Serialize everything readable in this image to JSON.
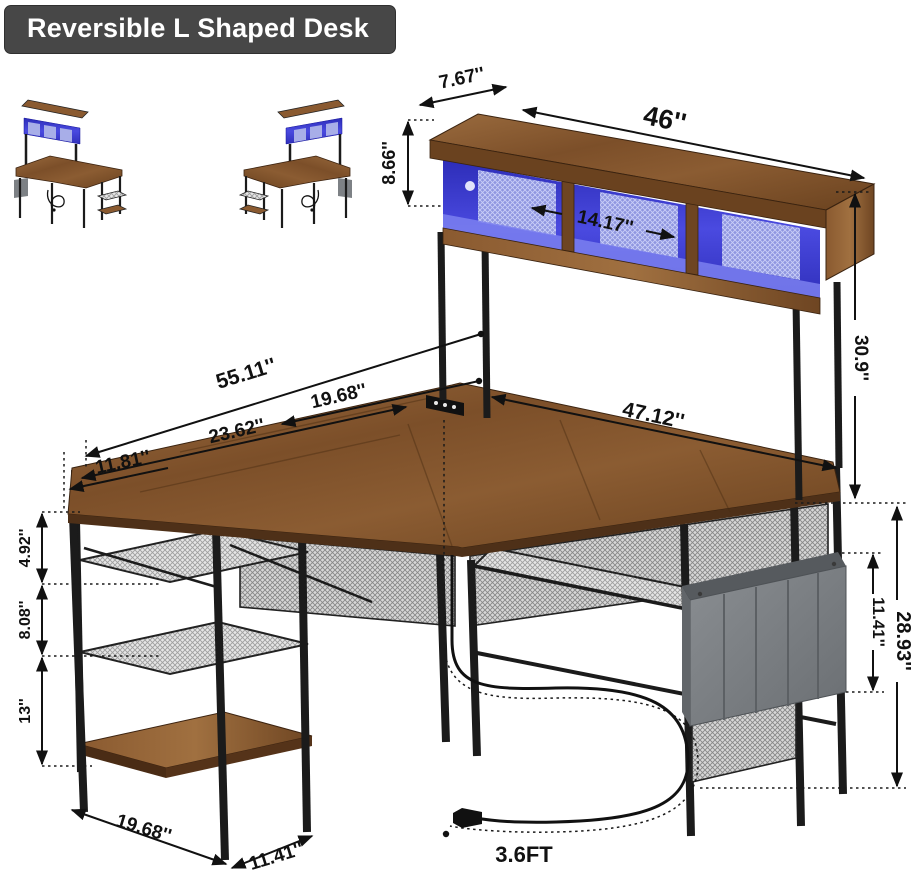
{
  "title_badge": "Reversible L Shaped Desk",
  "dims": {
    "hutch_depth": "7.67''",
    "hutch_length": "46''",
    "hutch_height": "8.66''",
    "cubby_width": "14.17''",
    "hutch_rise": "30.9''",
    "total_length": "55.11''",
    "return_depth": "19.68''",
    "right_length": "47.12''",
    "left_length": "23.62''",
    "left_depth": "11.81''",
    "shelf_gap_top": "4.92''",
    "shelf_gap_mid": "8.08''",
    "shelf_gap_bottom": "13''",
    "pocket_height": "11.41''",
    "desk_height": "28.93''",
    "base_length": "19.68''",
    "base_depth": "11.41''",
    "cord_length": "3.6FT"
  },
  "colors": {
    "wood": "#8a5a30",
    "led_blue": "#3c3cce",
    "frame_black": "#1b1b1b",
    "mesh_gray": "#d9d9d9",
    "bag_gray": "#7d8185",
    "badge_bg": "#474747",
    "dimension_ink": "#111111",
    "background": "#ffffff"
  }
}
